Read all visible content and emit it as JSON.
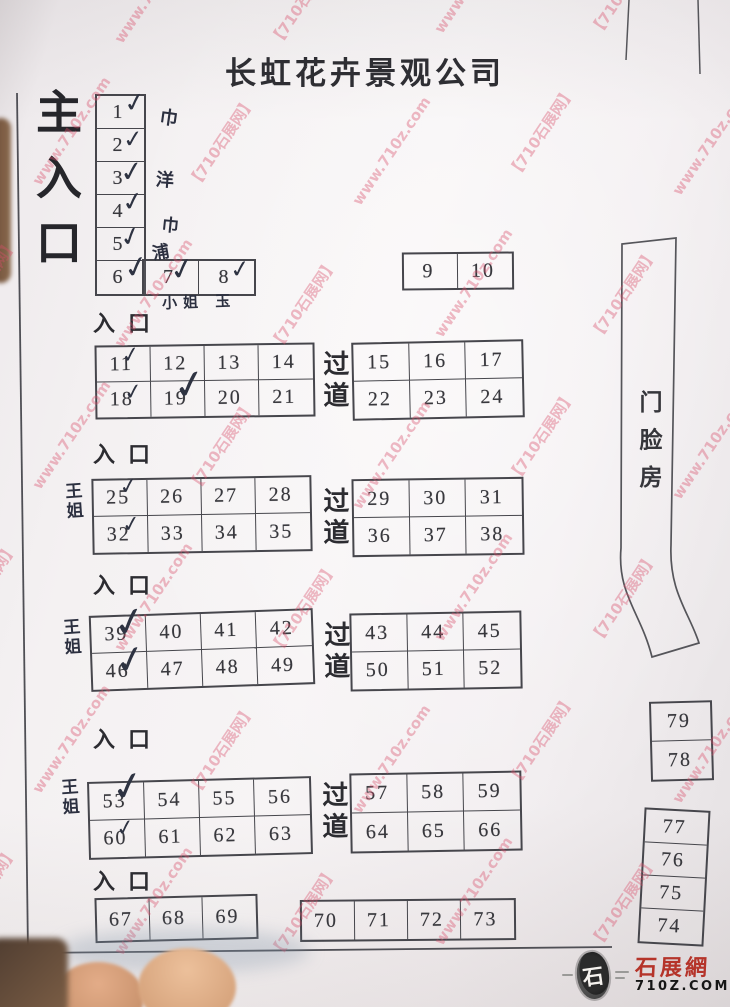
{
  "title": "长虹花卉景观公司",
  "labels": {
    "main_entrance": "主入口",
    "entrance": "入口",
    "aisle": "过道",
    "storefront": "门脸房"
  },
  "watermark": {
    "brand": "【710石展网】",
    "url": "www.710z.com",
    "color": "#d94f6b"
  },
  "logo": {
    "name": "石展網",
    "domain": "710Z.COM",
    "seal_char": "石"
  },
  "handwriting": {
    "check_mark": "✓",
    "owner": "王姐",
    "notes": {
      "beside_1": "巾",
      "beside_3": "洋",
      "beside_4": "巾",
      "beside_5": "浦",
      "below_7_8": "小姐 玉"
    }
  },
  "booths": {
    "left_column": [
      "1",
      "2",
      "3",
      "4",
      "5",
      "6"
    ],
    "row_7_8": [
      "7",
      "8"
    ],
    "box_9_10": [
      "9",
      "10"
    ],
    "sections": [
      {
        "left": [
          [
            "11",
            "12",
            "13",
            "14"
          ],
          [
            "18",
            "19",
            "20",
            "21"
          ]
        ],
        "right": [
          [
            "15",
            "16",
            "17"
          ],
          [
            "22",
            "23",
            "24"
          ]
        ]
      },
      {
        "left": [
          [
            "25",
            "26",
            "27",
            "28"
          ],
          [
            "32",
            "33",
            "34",
            "35"
          ]
        ],
        "right": [
          [
            "29",
            "30",
            "31"
          ],
          [
            "36",
            "37",
            "38"
          ]
        ]
      },
      {
        "left": [
          [
            "39",
            "40",
            "41",
            "42"
          ],
          [
            "46",
            "47",
            "48",
            "49"
          ]
        ],
        "right": [
          [
            "43",
            "44",
            "45"
          ],
          [
            "50",
            "51",
            "52"
          ]
        ]
      },
      {
        "left": [
          [
            "53",
            "54",
            "55",
            "56"
          ],
          [
            "60",
            "61",
            "62",
            "63"
          ]
        ],
        "right": [
          [
            "57",
            "58",
            "59"
          ],
          [
            "64",
            "65",
            "66"
          ]
        ]
      }
    ],
    "bottom_left_row": [
      "67",
      "68",
      "69"
    ],
    "bottom_right_row": [
      "70",
      "71",
      "72",
      "73"
    ],
    "right_pair": [
      "79",
      "78"
    ],
    "right_quad": [
      "77",
      "76",
      "75",
      "74"
    ]
  },
  "checked": [
    "1",
    "2",
    "3",
    "4",
    "5",
    "6",
    "7",
    "8",
    "11",
    "18",
    "19",
    "25",
    "32",
    "39",
    "46",
    "53",
    "60"
  ]
}
